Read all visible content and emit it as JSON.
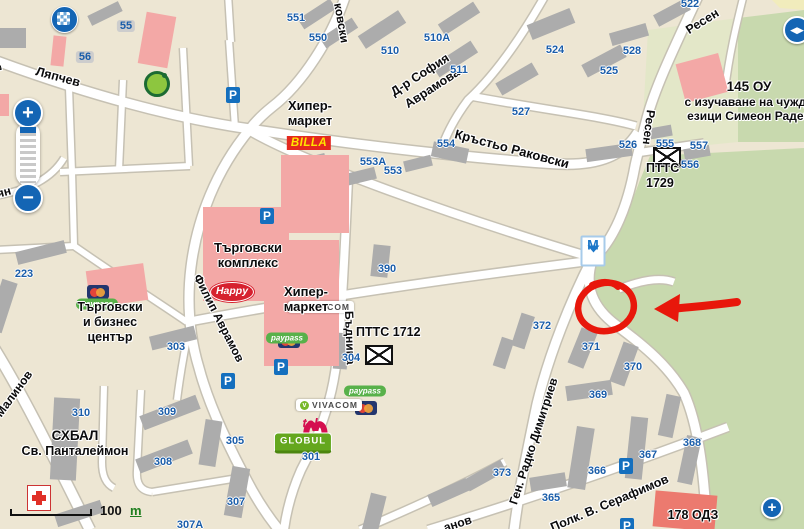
{
  "map": {
    "street_labels": [
      {
        "t": "Ляпчев",
        "x": 36,
        "y": 64,
        "r": 15,
        "s": 12.5
      },
      {
        "t": "ковски",
        "x": 338,
        "y": -4,
        "r": 80,
        "s": 12
      },
      {
        "t": "Кръстьо Раковски",
        "x": 455,
        "y": 126,
        "r": 15,
        "s": 13
      },
      {
        "t": "Д-р София",
        "x": 392,
        "y": 86,
        "r": -33,
        "s": 12.5
      },
      {
        "t": "Аврамова",
        "x": 406,
        "y": 98,
        "r": -33,
        "s": 12.5
      },
      {
        "t": "Ресен",
        "x": 687,
        "y": 24,
        "r": -32,
        "s": 12.5
      },
      {
        "t": "Ресен",
        "x": 651,
        "y": 103,
        "r": 97,
        "s": 12
      },
      {
        "t": "Филип Аврамов",
        "x": 197,
        "y": 268,
        "r": 63,
        "s": 12
      },
      {
        "t": "Бъднина",
        "x": 349,
        "y": 304,
        "r": 88,
        "s": 12
      },
      {
        "t": "Ген. Радко Димитриев",
        "x": 513,
        "y": 497,
        "r": -72,
        "s": 12
      },
      {
        "t": "Полк. В. Серафимов",
        "x": 551,
        "y": 521,
        "r": -23,
        "s": 12.5
      },
      {
        "t": "ндър Малинов",
        "x": -22,
        "y": 436,
        "r": -54,
        "s": 12
      },
      {
        "t": "ян",
        "x": -3,
        "y": 187,
        "r": -15,
        "s": 12
      },
      {
        "t": "нд",
        "x": -4,
        "y": 50,
        "r": 75,
        "s": 12
      },
      {
        "t": "анов",
        "x": 444,
        "y": 521,
        "r": -18,
        "s": 12
      }
    ],
    "building_numbers": [
      {
        "v": "55",
        "x": 126,
        "y": 26,
        "badge": true
      },
      {
        "v": "56",
        "x": 85,
        "y": 57,
        "badge": true
      },
      {
        "v": "551",
        "x": 296,
        "y": 18
      },
      {
        "v": "550",
        "x": 318,
        "y": 38
      },
      {
        "v": "510",
        "x": 390,
        "y": 51
      },
      {
        "v": "510А",
        "x": 437,
        "y": 38
      },
      {
        "v": "511",
        "x": 459,
        "y": 70
      },
      {
        "v": "524",
        "x": 555,
        "y": 50
      },
      {
        "v": "525",
        "x": 609,
        "y": 71
      },
      {
        "v": "527",
        "x": 521,
        "y": 112
      },
      {
        "v": "528",
        "x": 632,
        "y": 51
      },
      {
        "v": "522",
        "x": 690,
        "y": 4
      },
      {
        "v": "526",
        "x": 628,
        "y": 145
      },
      {
        "v": "555",
        "x": 665,
        "y": 144
      },
      {
        "v": "556",
        "x": 690,
        "y": 165
      },
      {
        "v": "557",
        "x": 699,
        "y": 146
      },
      {
        "v": "553А",
        "x": 373,
        "y": 162
      },
      {
        "v": "553",
        "x": 393,
        "y": 171
      },
      {
        "v": "554",
        "x": 446,
        "y": 144
      },
      {
        "v": "390",
        "x": 387,
        "y": 269
      },
      {
        "v": "304",
        "x": 351,
        "y": 358
      },
      {
        "v": "303",
        "x": 176,
        "y": 347
      },
      {
        "v": "223",
        "x": 24,
        "y": 274
      },
      {
        "v": "305",
        "x": 235,
        "y": 441
      },
      {
        "v": "307",
        "x": 236,
        "y": 502
      },
      {
        "v": "307А",
        "x": 190,
        "y": 525
      },
      {
        "v": "308",
        "x": 163,
        "y": 462
      },
      {
        "v": "309",
        "x": 167,
        "y": 412
      },
      {
        "v": "310",
        "x": 81,
        "y": 413
      },
      {
        "v": "301",
        "x": 311,
        "y": 457
      },
      {
        "v": "372",
        "x": 542,
        "y": 326
      },
      {
        "v": "371",
        "x": 591,
        "y": 347
      },
      {
        "v": "370",
        "x": 633,
        "y": 367
      },
      {
        "v": "369",
        "x": 598,
        "y": 395
      },
      {
        "v": "368",
        "x": 692,
        "y": 443
      },
      {
        "v": "367",
        "x": 648,
        "y": 455
      },
      {
        "v": "366",
        "x": 597,
        "y": 471
      },
      {
        "v": "365",
        "x": 551,
        "y": 498
      },
      {
        "v": "373",
        "x": 502,
        "y": 473
      }
    ],
    "poi": [
      {
        "id": "billa-hypermarket-label",
        "x": 272,
        "y": 98,
        "w": 76,
        "align": "center",
        "lines": [
          "Хипер-",
          "маркет"
        ],
        "size": 13
      },
      {
        "id": "targovski-kompleks-label",
        "x": 200,
        "y": 240,
        "w": 96,
        "align": "center",
        "lines": [
          "Търговски",
          "комплекс"
        ],
        "size": 13
      },
      {
        "id": "hypermarket-2-label",
        "x": 268,
        "y": 284,
        "w": 76,
        "align": "center",
        "lines": [
          "Хипер-",
          "маркет"
        ],
        "size": 13
      },
      {
        "id": "business-center-label",
        "x": 62,
        "y": 300,
        "w": 96,
        "align": "center",
        "lines": [
          "Търговски",
          "и бизнес",
          "център"
        ],
        "size": 12.5
      },
      {
        "id": "ptts-1712-label",
        "x": 356,
        "y": 325,
        "w": 90,
        "align": "left",
        "lines": [
          "ПТТС 1712"
        ],
        "size": 12.5
      },
      {
        "id": "ptts-1729-label",
        "x": 646,
        "y": 161,
        "w": 60,
        "align": "left",
        "lines": [
          "ПТТС",
          "1729"
        ],
        "size": 12.5
      },
      {
        "id": "school-145-label",
        "x": 664,
        "y": 79,
        "w": 170,
        "align": "center",
        "lines": [
          "145 ОУ",
          "с изучаване на чужди",
          "езици Симеон Радев"
        ],
        "size": 12,
        "size1": 13.5
      },
      {
        "id": "shbal-hospital-label",
        "x": 20,
        "y": 428,
        "w": 110,
        "align": "center",
        "lines": [
          "СХБАЛ",
          "Св. Панталеймон"
        ],
        "size": 12.5,
        "size1": 13.5
      },
      {
        "id": "odz-178-label",
        "x": 654,
        "y": 508,
        "w": 78,
        "align": "center",
        "lines": [
          "178 ОДЗ"
        ],
        "size": 12.5
      }
    ],
    "icons": [
      {
        "type": "parking",
        "x": 233,
        "y": 95
      },
      {
        "type": "parking",
        "x": 267,
        "y": 216
      },
      {
        "type": "parking",
        "x": 228,
        "y": 381
      },
      {
        "type": "parking",
        "x": 281,
        "y": 367
      },
      {
        "type": "parking",
        "x": 626,
        "y": 466
      },
      {
        "type": "parking",
        "x": 627,
        "y": 526
      },
      {
        "type": "metro",
        "x": 593,
        "y": 251
      },
      {
        "type": "envelope",
        "x": 667,
        "y": 157
      },
      {
        "type": "envelope",
        "x": 379,
        "y": 355
      },
      {
        "type": "mastercard",
        "x": 98,
        "y": 292
      },
      {
        "type": "paypass",
        "x": 97,
        "y": 304
      },
      {
        "type": "mastercard",
        "x": 289,
        "y": 327
      },
      {
        "type": "paypass",
        "x": 287,
        "y": 338
      },
      {
        "type": "mastercard",
        "x": 366,
        "y": 380
      },
      {
        "type": "paypass",
        "x": 365,
        "y": 391
      },
      {
        "type": "vivacom",
        "x": 321,
        "y": 307
      },
      {
        "type": "vivacom",
        "x": 329,
        "y": 405
      },
      {
        "type": "mtel",
        "x": 310,
        "y": 423
      },
      {
        "type": "globul",
        "x": 303,
        "y": 443
      },
      {
        "type": "happy",
        "x": 232,
        "y": 292
      },
      {
        "type": "billa",
        "x": 309,
        "y": 143
      },
      {
        "type": "fantastico",
        "x": 157,
        "y": 42
      },
      {
        "type": "hospital",
        "x": 39,
        "y": 430
      }
    ],
    "icon_text": {
      "parking": "P",
      "metro": "М",
      "paypass": "paypass",
      "vivacom": "VIVACOM",
      "mtel": "tel",
      "globul": "GLOBUL",
      "happy": "Happy",
      "billa": "BILLA"
    }
  },
  "controls": {
    "zoom_in": "+",
    "zoom_out": "−",
    "pan_icon": "◀▶",
    "zoom_in_small": "+"
  },
  "scale": {
    "value": "100",
    "unit": "m"
  },
  "annotation": {
    "color": "#E8170B",
    "circle": {
      "cx": 606,
      "cy": 307,
      "rx": 28,
      "ry": 24,
      "rot": -12
    },
    "arrow": {
      "from_x": 737,
      "from_y": 302,
      "to_x": 672,
      "to_y": 309,
      "head": "654,309 680,294 678,322"
    }
  },
  "colors": {
    "background": "#EDE6D3",
    "park": "#C8D9AE",
    "school_grounds": "#E3E7C8",
    "yellow_road": "#F1ECBC",
    "road_fill": "#FFFFFF",
    "road_casing": "#C6C1B3",
    "building": "#ACACAC",
    "building_pink": "#F3A8A6",
    "building_red": "#EC7A6F",
    "number_blue": "#1A5DA9",
    "control_blue": "#1465B4",
    "annotation_red": "#E8170B"
  }
}
